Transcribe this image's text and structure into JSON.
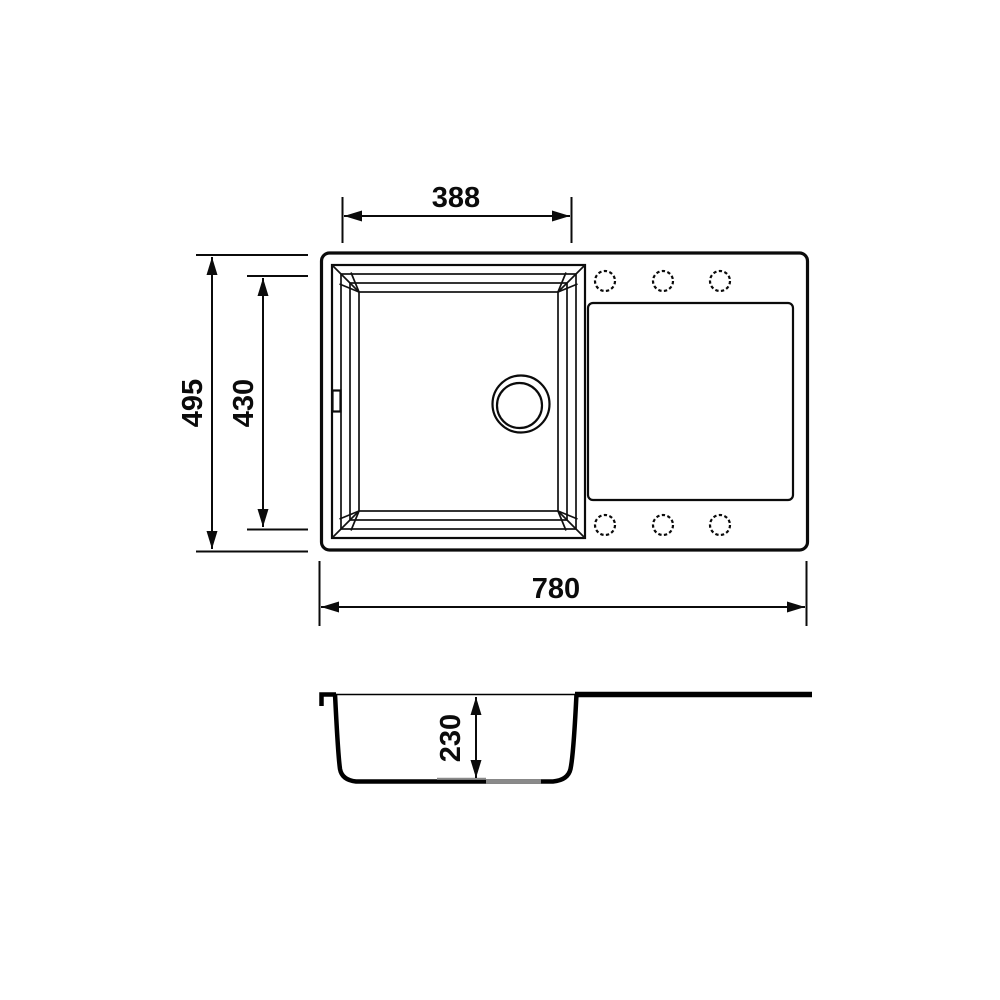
{
  "drawing": {
    "background_color": "#ffffff",
    "line_color": "#000000",
    "shade_color": "#8a8a8a",
    "top_view": {
      "dim_basin_width": "388",
      "dim_overall_depth": "495",
      "dim_basin_inner_depth": "430",
      "dim_overall_width": "780"
    },
    "side_view": {
      "dim_bowl_depth": "230"
    }
  }
}
